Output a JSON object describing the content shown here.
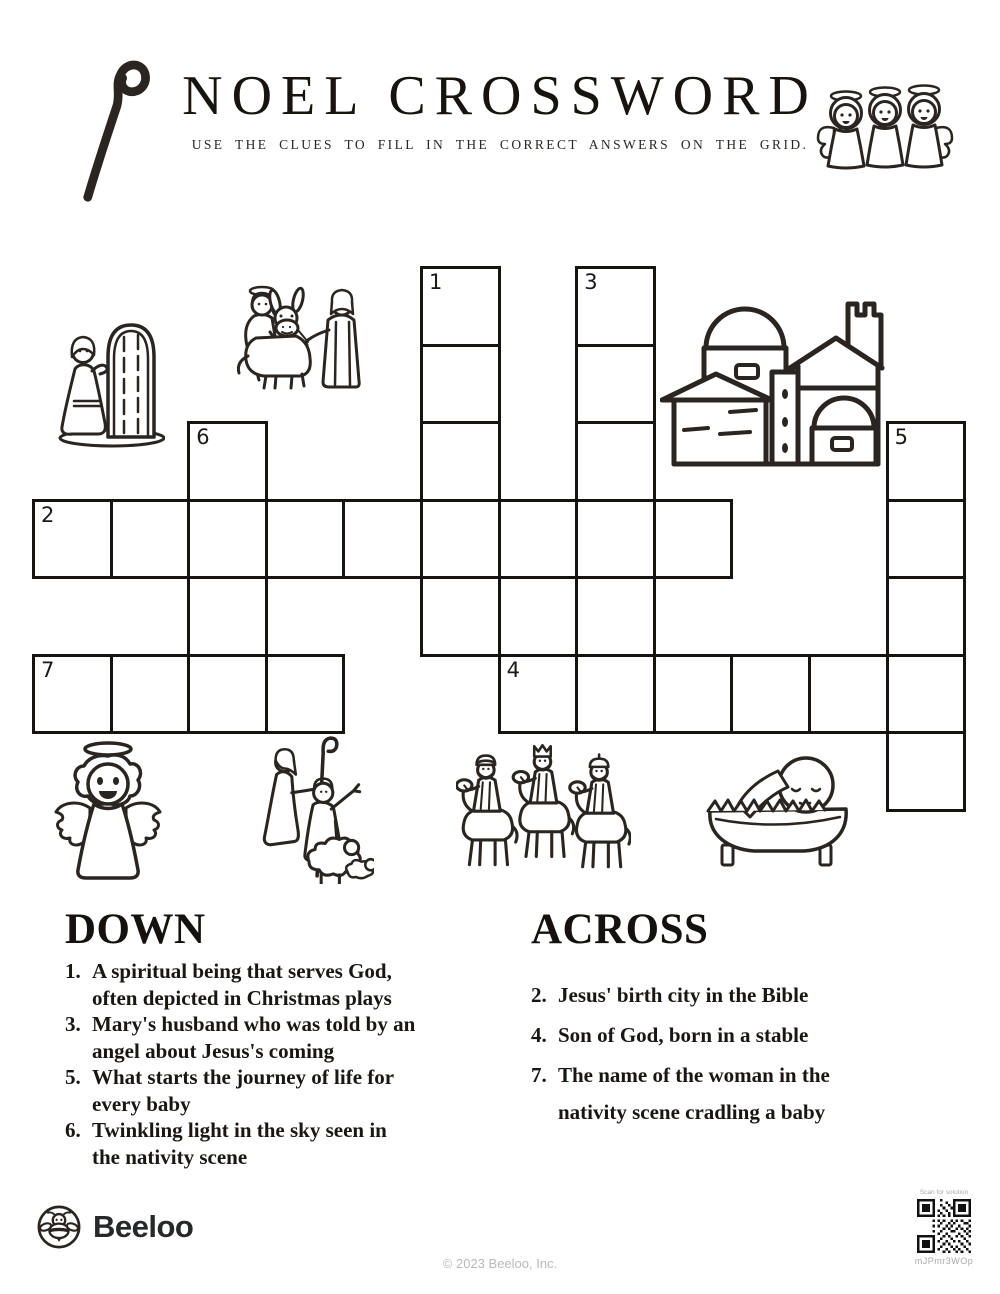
{
  "header": {
    "title": "NOEL CROSSWORD",
    "subtitle": "USE THE CLUES TO FILL IN THE CORRECT ANSWERS ON THE GRID."
  },
  "grid": {
    "cols": 12,
    "rows": 7,
    "cell_w": 77.6,
    "cell_h": 77.5,
    "origin_x": 32,
    "origin_y": 266,
    "cells": [
      {
        "col": 5,
        "row": 0,
        "num": "1"
      },
      {
        "col": 7,
        "row": 0,
        "num": "3"
      },
      {
        "col": 5,
        "row": 1
      },
      {
        "col": 7,
        "row": 1
      },
      {
        "col": 2,
        "row": 2,
        "num": "6"
      },
      {
        "col": 5,
        "row": 2
      },
      {
        "col": 7,
        "row": 2
      },
      {
        "col": 11,
        "row": 2,
        "num": "5"
      },
      {
        "col": 0,
        "row": 3,
        "num": "2"
      },
      {
        "col": 1,
        "row": 3
      },
      {
        "col": 2,
        "row": 3
      },
      {
        "col": 3,
        "row": 3
      },
      {
        "col": 4,
        "row": 3
      },
      {
        "col": 5,
        "row": 3
      },
      {
        "col": 6,
        "row": 3
      },
      {
        "col": 7,
        "row": 3
      },
      {
        "col": 8,
        "row": 3
      },
      {
        "col": 11,
        "row": 3
      },
      {
        "col": 2,
        "row": 4
      },
      {
        "col": 5,
        "row": 4
      },
      {
        "col": 7,
        "row": 4
      },
      {
        "col": 11,
        "row": 4
      },
      {
        "col": 0,
        "row": 5,
        "num": "7"
      },
      {
        "col": 1,
        "row": 5
      },
      {
        "col": 2,
        "row": 5
      },
      {
        "col": 3,
        "row": 5
      },
      {
        "col": 6,
        "row": 5,
        "num": "4"
      },
      {
        "col": 7,
        "row": 5
      },
      {
        "col": 8,
        "row": 5
      },
      {
        "col": 9,
        "row": 5
      },
      {
        "col": 10,
        "row": 5
      },
      {
        "col": 11,
        "row": 5
      },
      {
        "col": 11,
        "row": 6
      }
    ]
  },
  "clues": {
    "down": {
      "heading": "DOWN",
      "items": [
        {
          "num": "1.",
          "lines": [
            "A spiritual being that serves God,",
            "often depicted in Christmas plays"
          ]
        },
        {
          "num": "3.",
          "lines": [
            "Mary's husband who was told by an",
            "angel about Jesus's coming"
          ]
        },
        {
          "num": "5.",
          "lines": [
            "What starts the journey of life for",
            "every baby"
          ]
        },
        {
          "num": "6.",
          "lines": [
            "Twinkling light in the sky seen in",
            "the nativity scene"
          ]
        }
      ]
    },
    "across": {
      "heading": "ACROSS",
      "items": [
        {
          "num": "2.",
          "lines": [
            "Jesus' birth city in the Bible"
          ]
        },
        {
          "num": "4.",
          "lines": [
            "Son of God, born in a stable"
          ]
        },
        {
          "num": "7.",
          "lines": [
            "The name of the woman in the",
            "nativity scene cradling a baby"
          ]
        }
      ]
    }
  },
  "illustrations": [
    {
      "name": "shepherds-crook-image",
      "depicts": "shepherd's crook staff"
    },
    {
      "name": "three-angels-image",
      "depicts": "three angels with halos"
    },
    {
      "name": "figure-at-door-image",
      "depicts": "robed figure at an arched door"
    },
    {
      "name": "mary-donkey-joseph-image",
      "depicts": "Mary on a donkey led by Joseph"
    },
    {
      "name": "bethlehem-city-image",
      "depicts": "Bethlehem city with domes and tower"
    },
    {
      "name": "angel-image",
      "depicts": "angel with halo and wings"
    },
    {
      "name": "shepherds-sheep-image",
      "depicts": "shepherds with sheep"
    },
    {
      "name": "three-wise-men-image",
      "depicts": "three wise men on camels"
    },
    {
      "name": "baby-manger-image",
      "depicts": "baby Jesus in a manger"
    }
  ],
  "footer": {
    "brand": "Beeloo",
    "copyright": "© 2023 Beeloo, Inc.",
    "qr_caption": "Scan for solution",
    "qr_code": "mJPmr3WOp"
  },
  "colors": {
    "ink": "#2a2520",
    "grid_line": "#161310",
    "muted": "#ababab"
  }
}
